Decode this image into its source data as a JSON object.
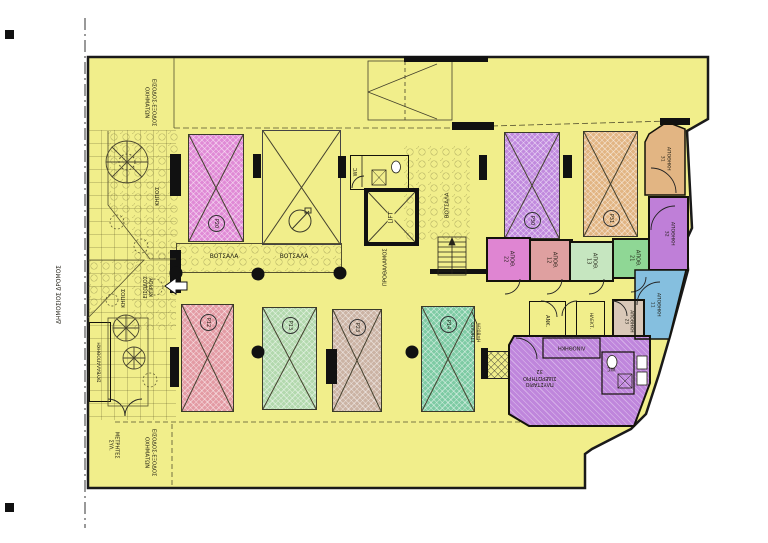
{
  "site": {
    "public_road": "ΔΗΜΟΣΙΟΣ ΔΡΟΜΟΣ",
    "vehicle_access_line1": "ΕΙΣΟΔΟΣ-ΕΞΟΔΟΣ",
    "vehicle_access_line2": "ΟΧΗΜΑΤΩΝ",
    "meters_line1": "ΜΕΤΡΗΤΕΣ",
    "meters_line2": "ΣΥΛ.",
    "building_entrance_line1": "ΕΙΣΟΔΟΣ",
    "building_entrance_line2": "ΚΤΙΡΙΟΥ",
    "garden": "ΚΗΠΟΣ",
    "garbage_store": "ΣΚΥΒΑΛΑΠΟΘΗΚΗ",
    "pebbles": "ΒΟΤΣΑΛΑ",
    "parapet_line1": "ΣΤΗΘΑΙΟ",
    "parapet_line2": "H=80cm"
  },
  "core": {
    "lift": "LIFT",
    "wc": "WC",
    "vestibule": "ΠΡΟΘΑΛΑΜΟΣ"
  },
  "parking": {
    "p20": "P20",
    "p30": "P30",
    "p31": "P31",
    "p12": "P12",
    "p13": "P13",
    "p23": "P23",
    "p14": "P14"
  },
  "rooms": {
    "s22_name": "ΑΠΟΘ.",
    "s22_num": "22",
    "s12_name": "ΑΠΟΘ.",
    "s12_num": "12",
    "s13_name": "ΑΠΟΘ.",
    "s13_num": "13",
    "s21_name": "ΑΠΟΘ.",
    "s21_num": "21",
    "s31_name": "ΑΠΟΘΗΚΗ",
    "s31_num": "31",
    "s32_name": "ΑΠΟΘΗΚΗ",
    "s32_num": "32",
    "s11_name": "ΑΠΟΘΗΚΗ",
    "s11_num": "11",
    "s23_name": "ΑΠΟΘΗΚΗ",
    "s23_num": "23",
    "machine_room": "ΑΝΚ.",
    "electrical": "ΗΛΕΚΤ.",
    "linen": "ΛΙΝΟΘΗΚΗ",
    "laundry_line1": "ΠΛΥΣΤΑΡΙΟ",
    "laundry_line2": "ΣΙΔΕΡΩΤΗΡΙΟ",
    "laundry_num": "32",
    "laundry_wc": "WC"
  },
  "colors": {
    "plot_yellow": "#f1ee8b",
    "stall_p20": "#e08ad6",
    "stall_p30": "#c18ade",
    "stall_p31": "#e2b583",
    "stall_p12": "#e39ba4",
    "stall_p13": "#b3d9ae",
    "stall_p23": "#cbb3a4",
    "stall_p14": "#7ecba4",
    "room_s22": "#df85d2",
    "room_s12": "#dfa0a0",
    "room_s13": "#c6e6c0",
    "room_s21": "#8fd795",
    "room_s31": "#e2b583",
    "room_s32": "#bf7fd8",
    "room_s11": "#85bfdf",
    "room_s23": "#d9c8b8",
    "laundry": "#bf86dc"
  }
}
